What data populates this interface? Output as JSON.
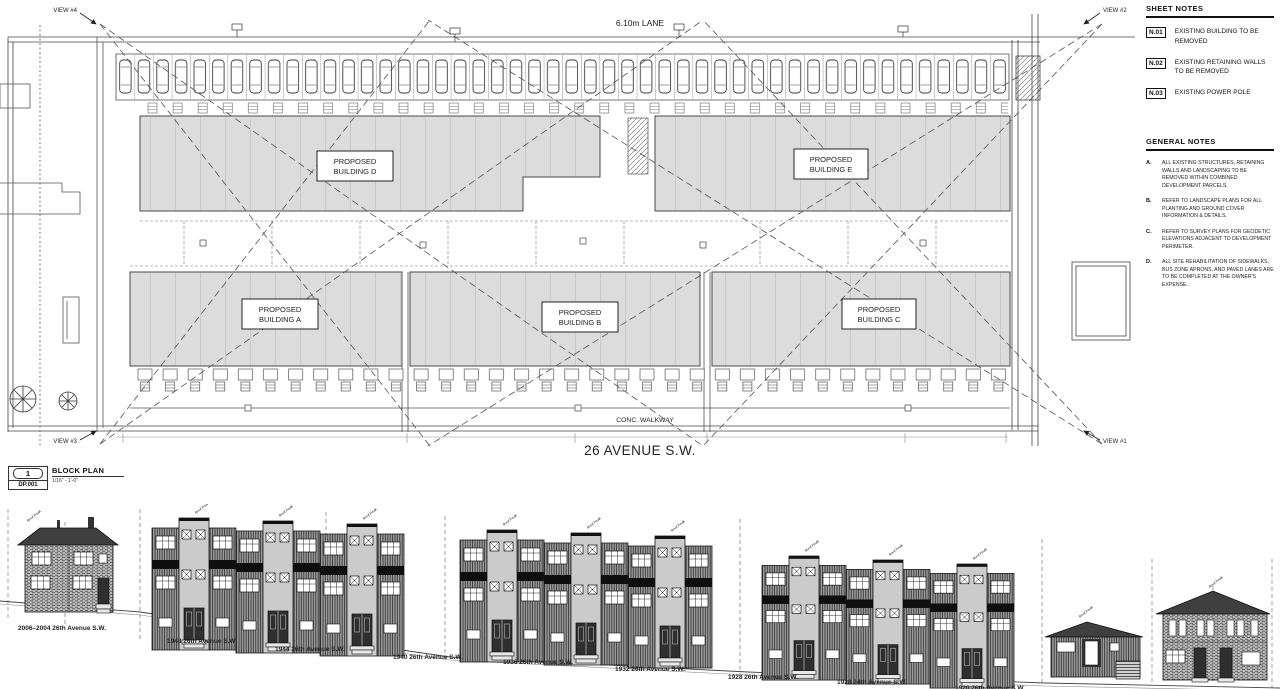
{
  "plan": {
    "lane_label": "6.10m LANE",
    "street_label": "26 AVENUE S.W.",
    "walkway_label": "CONC. WALKWAY",
    "view_labels": [
      "VIEW #1",
      "VIEW #2",
      "VIEW #3",
      "VIEW #4"
    ],
    "building_labels": [
      {
        "line1": "PROPOSED",
        "line2": "BUILDING A"
      },
      {
        "line1": "PROPOSED",
        "line2": "BUILDING B"
      },
      {
        "line1": "PROPOSED",
        "line2": "BUILDING C"
      },
      {
        "line1": "PROPOSED",
        "line2": "BUILDING D"
      },
      {
        "line1": "PROPOSED",
        "line2": "BUILDING E"
      }
    ],
    "colors": {
      "building_fill": "#dcdcdc",
      "line": "#444444"
    }
  },
  "title_block": {
    "detail_number": "1",
    "sheet_number": "DP.001",
    "title": "BLOCK PLAN",
    "scale": "1/16\" - 1'-0\""
  },
  "sheet_notes": {
    "title": "SHEET NOTES",
    "items": [
      {
        "tag": "N.01",
        "text": "EXISTING BUILDING TO BE REMOVED"
      },
      {
        "tag": "N.02",
        "text": "EXISTING RETAINING WALLS TO BE REMOVED"
      },
      {
        "tag": "N.03",
        "text": "EXISTING POWER POLE"
      }
    ]
  },
  "general_notes": {
    "title": "GENERAL NOTES",
    "items": [
      {
        "tag": "A.",
        "text": "ALL EXISTING STRUCTURES, RETAINING WALLS AND LANDSCAPING TO BE REMOVED WITHIN COMBINED DEVELOPMENT PARCELS."
      },
      {
        "tag": "B.",
        "text": "REFER TO LANDSCAPE PLANS FOR ALL PLANTING AND GROUND COVER INFORMATION & DETAILS."
      },
      {
        "tag": "C.",
        "text": "REFER TO SURVEY PLANS FOR GEODETIC ELEVATIONS ADJACENT TO DEVELOPMENT PERIMETER."
      },
      {
        "tag": "D.",
        "text": "ALL SITE REHABILITATION OF SIDEWALKS, BUS ZONE APRONS, AND PAVED LANES ARE TO BE COMPLETED AT THE OWNER'S EXPENSE."
      }
    ]
  },
  "elevations": {
    "roof_flag": "Roof Peak",
    "addresses": [
      "2006–2004 26th Avenue S.W.",
      "1948 26th Avenue S.W.",
      "1944 26th Avenue S.W.",
      "1940 26th Avenue S.W.",
      "1936 26th Avenue S.W.",
      "1932 26th Avenue S.W.",
      "1928 26th Avenue S.W.",
      "1928 24th Avenue S.W.",
      "1920 26th Avenue S.W."
    ]
  }
}
